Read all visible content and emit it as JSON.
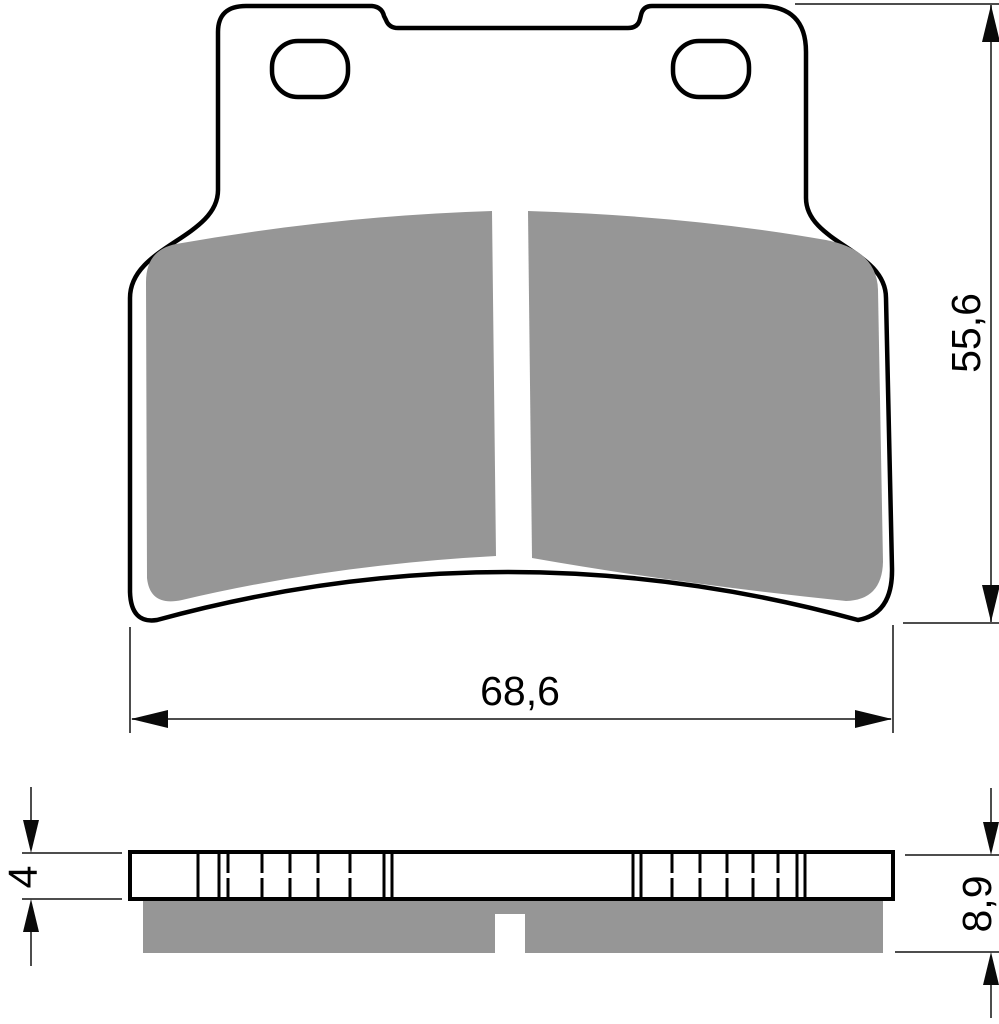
{
  "drawing": {
    "subject": "brake-pad-technical-drawing",
    "dimensions": {
      "height": {
        "label": "55,6"
      },
      "width": {
        "label": "68,6"
      },
      "backplate_thickness": {
        "label": "4"
      },
      "total_thickness": {
        "label": "8,9"
      }
    },
    "colors": {
      "friction_material": "#969696",
      "outline": "#000000",
      "dimension_lines": "#4d4d4d",
      "arrow": "#0a0a0a",
      "background": "#ffffff"
    }
  }
}
